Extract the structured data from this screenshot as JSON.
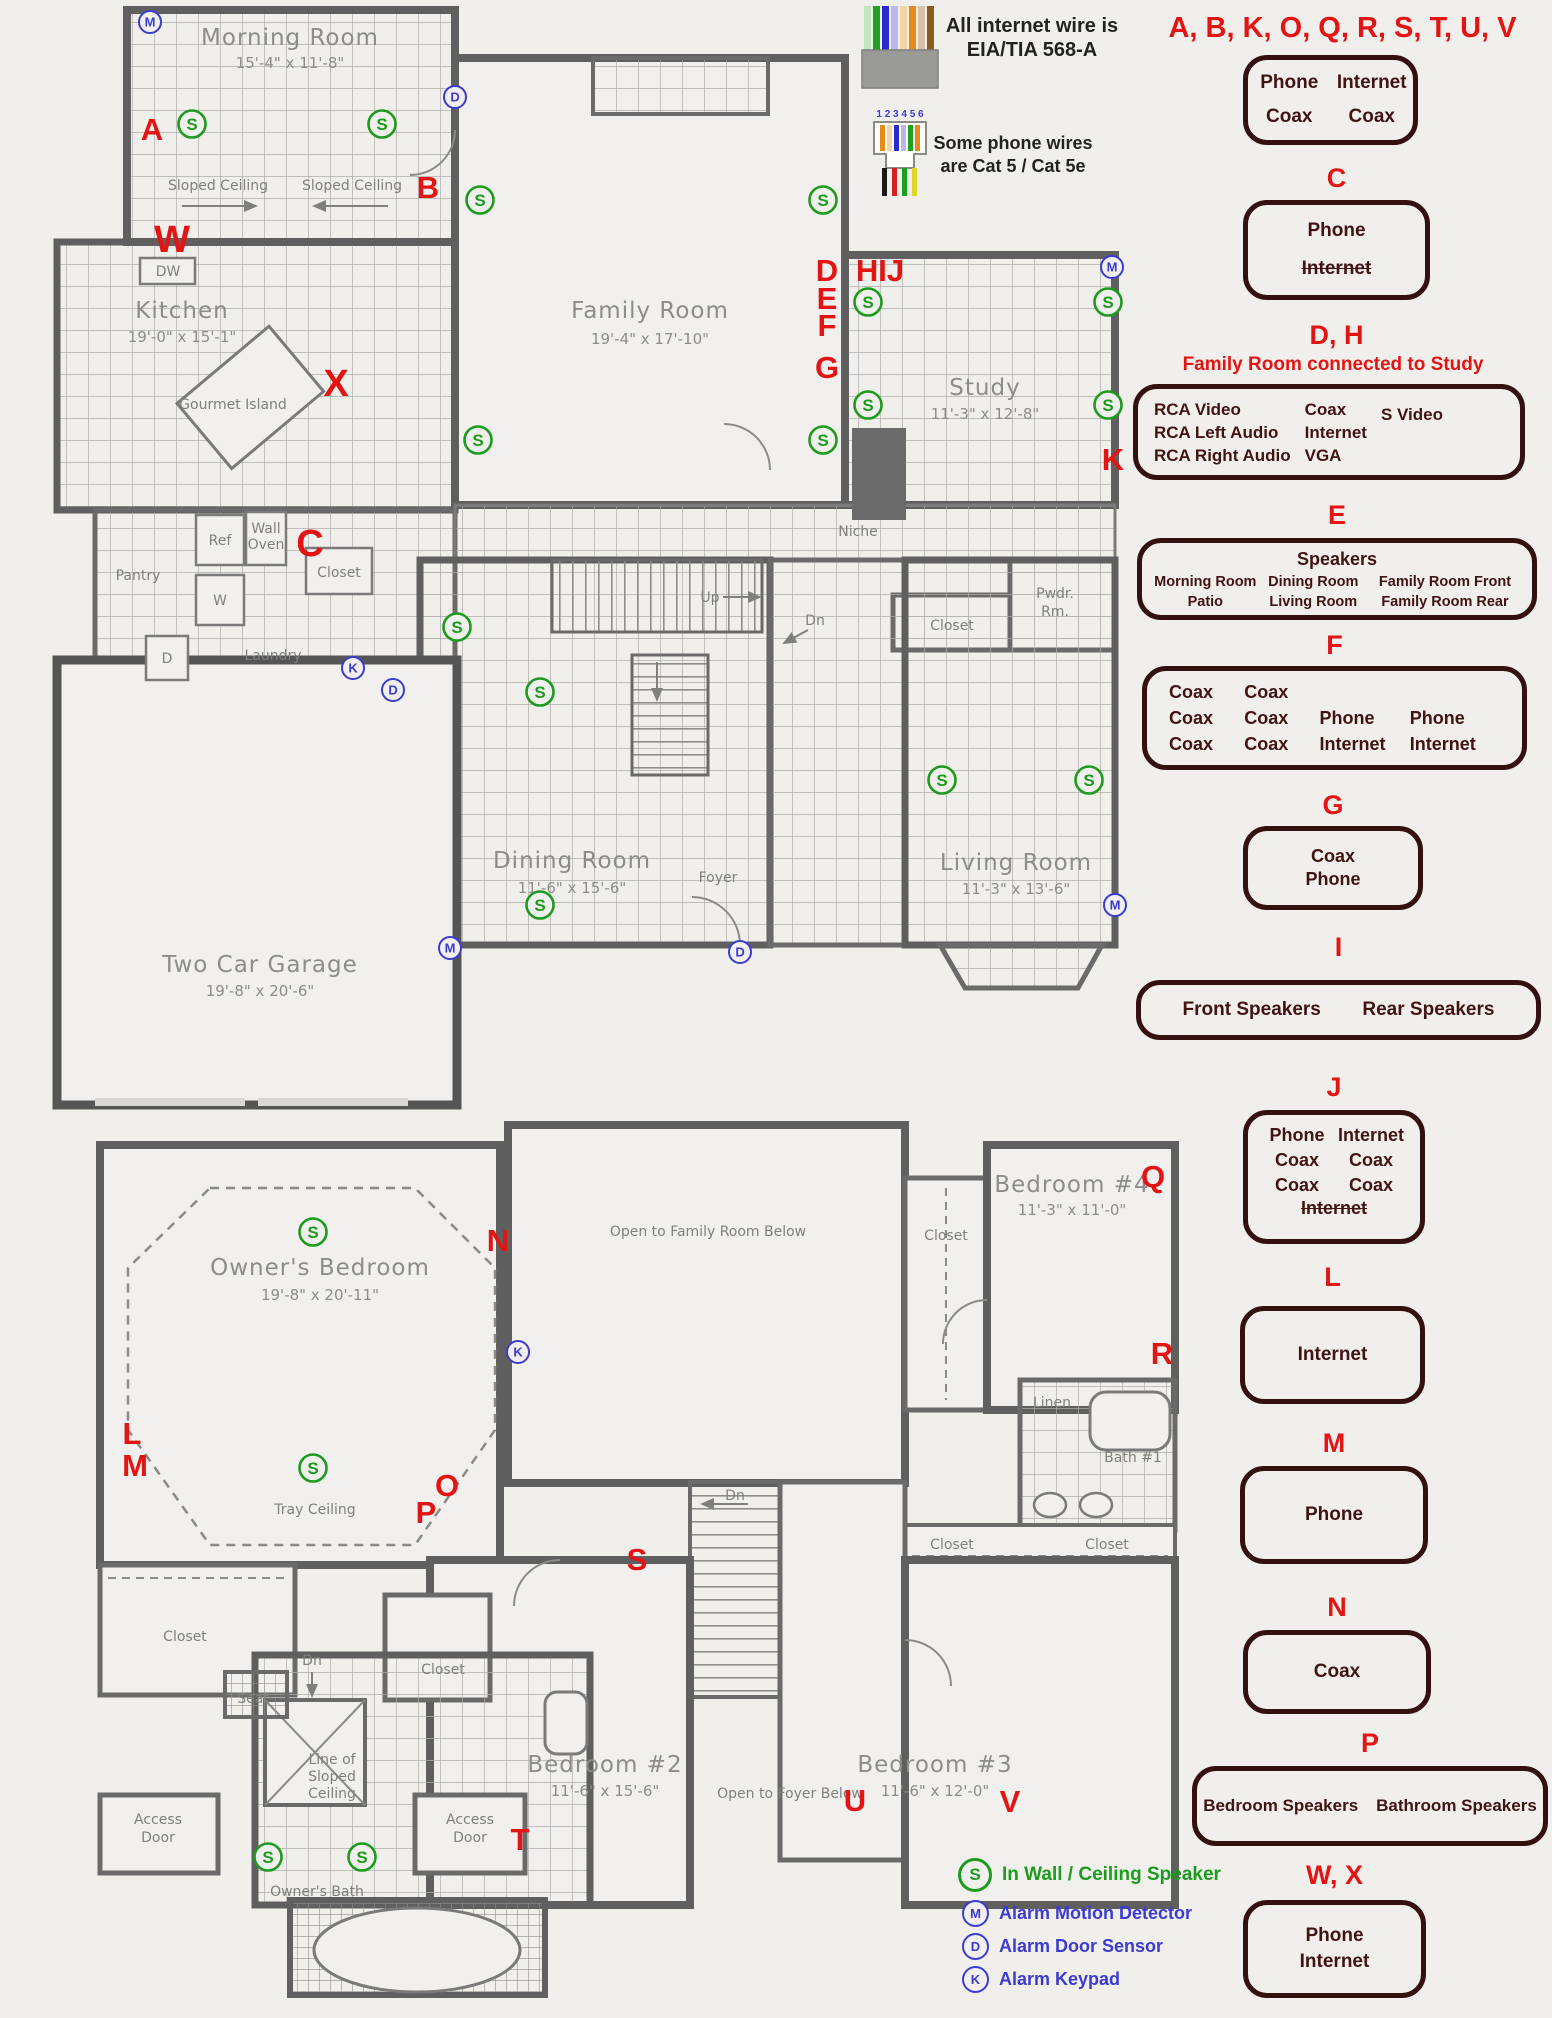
{
  "symbols": {
    "s": "S",
    "m": "M",
    "d": "D",
    "k": "K"
  },
  "notes": {
    "internet1": "All internet wire is",
    "internet2": "EIA/TIA 568-A",
    "phone1": "Some phone wires",
    "phone2": "are Cat 5 / Cat 5e",
    "connector_digits": "1 2 3 4 5 6"
  },
  "legend": {
    "speaker": "In Wall / Ceiling Speaker",
    "motion": "Alarm Motion Detector",
    "door": "Alarm Door Sensor",
    "keypad": "Alarm Keypad"
  },
  "callouts": {
    "group_title": "A, B, K, O, Q, R, S, T, U, V",
    "abk": {
      "r1c1": "Phone",
      "r1c2": "Internet",
      "r2c1": "Coax",
      "r2c2": "Coax"
    },
    "c": {
      "title": "C",
      "l1": "Phone",
      "l2": "Internet"
    },
    "dh": {
      "title": "D, H",
      "subtitle": "Family Room connected to Study",
      "col1": [
        "RCA Video",
        "RCA Left Audio",
        "RCA Right Audio"
      ],
      "col2": [
        "Coax",
        "Internet",
        "VGA"
      ],
      "col3": [
        "S Video"
      ]
    },
    "e": {
      "title": "E",
      "heading": "Speakers",
      "r1": [
        "Morning Room",
        "Dining Room",
        "Family Room Front"
      ],
      "r2": [
        "Patio",
        "Living Room",
        "Family Room Rear"
      ]
    },
    "f": {
      "title": "F",
      "r1": [
        "Coax",
        "Coax"
      ],
      "r2": [
        "Coax",
        "Coax",
        "Phone",
        "Phone"
      ],
      "r3": [
        "Coax",
        "Coax",
        "Internet",
        "Internet"
      ]
    },
    "g": {
      "title": "G",
      "l1": "Coax",
      "l2": "Phone"
    },
    "i": {
      "title": "I",
      "l1": "Front Speakers",
      "l2": "Rear Speakers"
    },
    "j": {
      "title": "J",
      "r1c1": "Phone",
      "r1c2": "Internet",
      "r2c1": "Coax",
      "r2c2": "Coax",
      "r3c1": "Coax",
      "r3c2": "Coax",
      "r4": "Internet"
    },
    "l": {
      "title": "L",
      "l1": "Internet"
    },
    "m": {
      "title": "M",
      "l1": "Phone"
    },
    "n": {
      "title": "N",
      "l1": "Coax"
    },
    "p": {
      "title": "P",
      "l1": "Bedroom Speakers",
      "l2": "Bathroom Speakers"
    },
    "wx": {
      "title": "W, X",
      "l1": "Phone",
      "l2": "Internet"
    }
  },
  "floor1": {
    "rooms": {
      "morning": {
        "name": "Morning Room",
        "dims": "15'-4\" x 11'-8\""
      },
      "kitchen": {
        "name": "Kitchen",
        "dims": "19'-0\" x 15'-1\""
      },
      "family": {
        "name": "Family Room",
        "dims": "19'-4\" x 17'-10\""
      },
      "study": {
        "name": "Study",
        "dims": "11'-3\" x 12'-8\""
      },
      "dining": {
        "name": "Dining Room",
        "dims": "11'-6\" x 15'-6\""
      },
      "living": {
        "name": "Living Room",
        "dims": "11'-3\" x 13'-6\""
      },
      "garage": {
        "name": "Two Car Garage",
        "dims": "19'-8\" x 20'-6\""
      }
    },
    "small": {
      "sloped1": "Sloped Ceiling",
      "sloped2": "Sloped Ceiling",
      "dw": "DW",
      "island": "Gourmet Island",
      "pantry": "Pantry",
      "ref": "Ref",
      "wall": "Wall",
      "oven": "Oven",
      "closet1": "Closet",
      "w": "W",
      "d": "D",
      "laundry": "Laundry",
      "up": "Up",
      "dn": "Dn",
      "niche": "Niche",
      "closet2": "Closet",
      "pwdr1": "Pwdr.",
      "pwdr2": "Rm.",
      "foyer": "Foyer"
    },
    "letters": {
      "a": "A",
      "b": "B",
      "c": "C",
      "w": "W",
      "x": "X",
      "d": "D",
      "e": "E",
      "f": "F",
      "g": "G",
      "hij": "HIJ",
      "k": "K"
    }
  },
  "floor2": {
    "rooms": {
      "owner": {
        "name": "Owner's Bedroom",
        "dims": "19'-8\" x 20'-11\""
      },
      "bed4": {
        "name": "Bedroom #4",
        "dims": "11'-3\" x 11'-0\""
      },
      "bed2": {
        "name": "Bedroom #2",
        "dims": "11'-6\" x 15'-6\""
      },
      "bed3": {
        "name": "Bedroom #3",
        "dims": "11'-6\" x 12'-0\""
      }
    },
    "small": {
      "open_family": "Open to Family Room Below",
      "closet_b4": "Closet",
      "tray": "Tray Ceiling",
      "linen": "Linen",
      "bath1": "Bath #1",
      "closet_b3": "Closet",
      "closet_bath": "Closet",
      "closet_owner": "Closet",
      "closet_hall": "Closet",
      "dn1": "Dn",
      "seat": "Seat",
      "line1": "Line of",
      "line2": "Sloped",
      "line3": "Ceiling",
      "access1a": "Access",
      "access1b": "Door",
      "access2a": "Access",
      "access2b": "Door",
      "owners_bath": "Owner's Bath",
      "dn2": "Dn",
      "open_foyer": "Open to Foyer Below"
    },
    "letters": {
      "l": "L",
      "m": "M",
      "n": "N",
      "o": "O",
      "p": "P",
      "q": "Q",
      "r": "R",
      "s": "S",
      "t": "T",
      "u": "U",
      "v": "V"
    }
  }
}
